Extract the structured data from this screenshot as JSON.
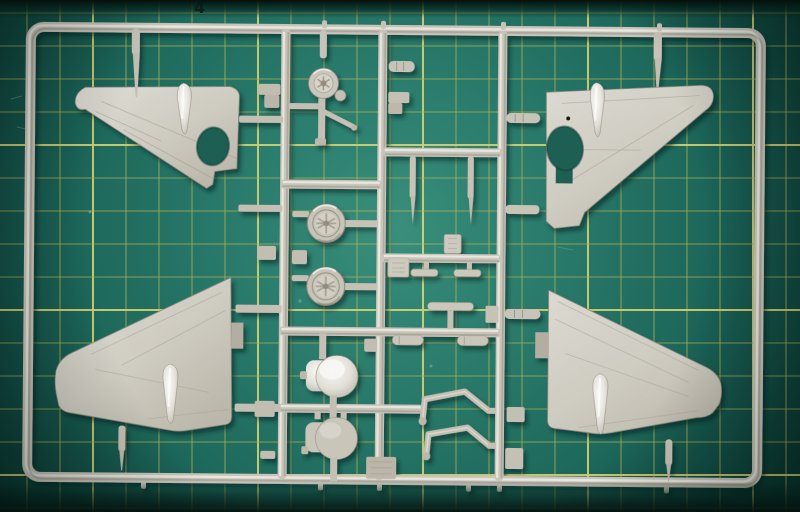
{
  "scene": {
    "type": "photograph",
    "subject": "Injection-moulded model aircraft parts sprue lying on a green self-healing cutting mat",
    "visible_parts": [
      "upper-left wing half",
      "upper-right wing half",
      "lower-left wing half",
      "lower-right wing half",
      "two spoked main wheels",
      "tail wheel with strut",
      "two round cowl discs",
      "two undercarriage legs",
      "two tailplane pieces",
      "drop-tank halves",
      "pitot pins",
      "small fittings"
    ]
  },
  "mat": {
    "corner_label": "4",
    "surface_color": "#27796a",
    "edge_color": "#0b352e",
    "grid": {
      "spacing_px": 33,
      "offset_x": 27,
      "offset_y": 13,
      "line_color": "#c9ba4e",
      "accent_line_color": "#ecdf74",
      "accent_every": 5,
      "accent_phase_x": 2,
      "accent_phase_y": 4
    }
  },
  "sprue": {
    "plastic_color": "#c9c5ba",
    "plastic_highlight": "#f1f0ea",
    "plastic_shadow": "#6b665a"
  }
}
